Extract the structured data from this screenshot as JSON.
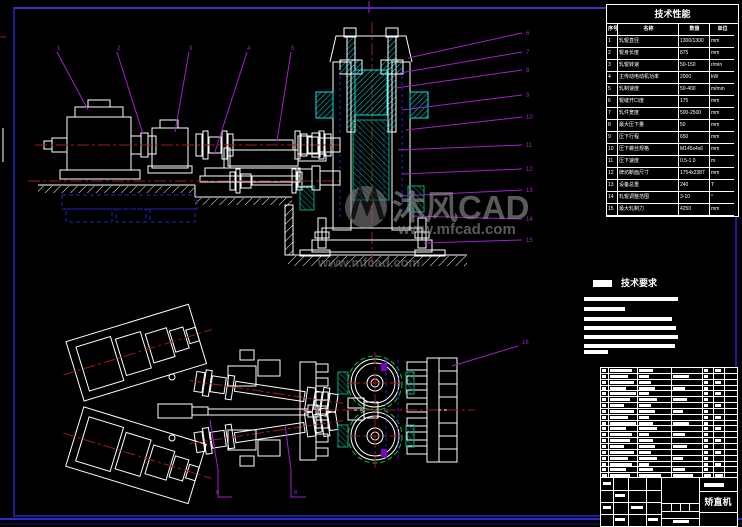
{
  "watermark": {
    "brand": "沐风CAD",
    "url": "www.mfcad.com",
    "secondary_url": "www.mfcad.com"
  },
  "spec_table": {
    "title": "技术性能",
    "columns": [
      "序号",
      "名称",
      "数值",
      "单位"
    ],
    "rows": [
      [
        "1",
        "轧辊直径",
        "1300/1300",
        "mm"
      ],
      [
        "2",
        "辊身长度",
        "875",
        "mm"
      ],
      [
        "3",
        "轧辊转速",
        "50-150",
        "r/min"
      ],
      [
        "4",
        "主传动电动机功率",
        "2000",
        "kW"
      ],
      [
        "5",
        "轧制速度",
        "50-400",
        "m/min"
      ],
      [
        "6",
        "辊缝开口度",
        "175",
        "mm"
      ],
      [
        "7",
        "轧件宽度",
        "500-2500",
        "mm"
      ],
      [
        "8",
        "最大压下量",
        "50",
        "mm"
      ],
      [
        "9",
        "压下行程",
        "650",
        "mm"
      ],
      [
        "10",
        "压下螺丝规格",
        "M145x4x6",
        "mm"
      ],
      [
        "11",
        "压下速度",
        "0.5-1.0",
        "m"
      ],
      [
        "12",
        "牌坊断面尺寸",
        "1754x2387",
        "mm"
      ],
      [
        "13",
        "设备总重",
        "240",
        "T"
      ],
      [
        "14",
        "轧辊调整范围",
        "3-10",
        "°"
      ],
      [
        "15",
        "最大轧制力",
        "4250",
        "mm"
      ]
    ]
  },
  "notes": {
    "label": "技术要求"
  },
  "bom": {
    "row_count": 19
  },
  "title_block": {
    "name": "矫直机"
  },
  "callouts": {
    "top": [
      "1",
      "2",
      "3",
      "4",
      "5"
    ],
    "right": [
      "6",
      "7",
      "8",
      "9",
      "10",
      "11",
      "12",
      "13",
      "14",
      "15"
    ],
    "plan": [
      "16"
    ],
    "sections": [
      "B",
      "B"
    ]
  },
  "colors": {
    "background": "#000000",
    "geometry": "#ffffff",
    "centerline": "#9e1a1a",
    "leader": "#a020c8",
    "hatch_cyan": "#00e5e5",
    "hatch_teal": "#00a888",
    "hidden_blue": "#2222bb",
    "pitch_green": "#00c832",
    "border_navy": "#1c1c96",
    "watermark_gray": "#969696"
  }
}
